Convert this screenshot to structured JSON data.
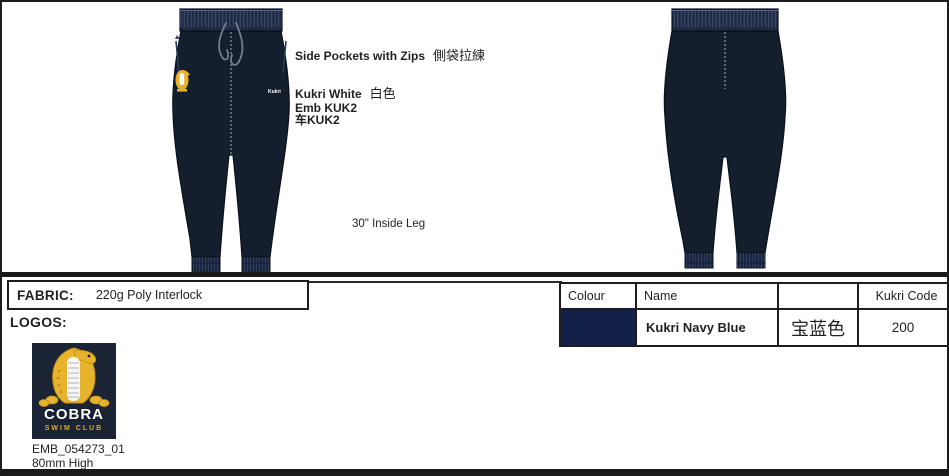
{
  "annotations": {
    "side_pockets_en": "Side Pockets with Zips",
    "side_pockets_zh": "側袋拉練",
    "kukri_white_en": "Kukri White",
    "kukri_white_zh": "白色",
    "emb_line": "Emb KUK2",
    "sew_line": "车KUK2",
    "inside_leg": "30\" Inside Leg"
  },
  "garment": {
    "hip_brand_text": "Kukri"
  },
  "fabric": {
    "label": "FABRIC:",
    "value": "220g Poly Interlock"
  },
  "logos": {
    "label": "LOGOS:",
    "badge_title": "COBRA",
    "badge_subtitle": "SWIM CLUB",
    "embroidery_code": "EMB_054273_01",
    "size_note": "80mm High"
  },
  "colour_table": {
    "headers": [
      "Colour",
      "Name",
      "",
      "Kukri Code"
    ],
    "row": {
      "swatch_color": "#13204a",
      "name": "Kukri Navy Blue",
      "name_zh": "宝蓝色",
      "kukri_code": "200"
    }
  },
  "colors": {
    "garment_navy": "#151e2d",
    "waistband_navy": "#1f2b42",
    "swatch_navy": "#13204a",
    "logo_background_navy": "#1b2435",
    "logo_gold": "#e8b32c",
    "divider_black": "#1a1a1a"
  }
}
